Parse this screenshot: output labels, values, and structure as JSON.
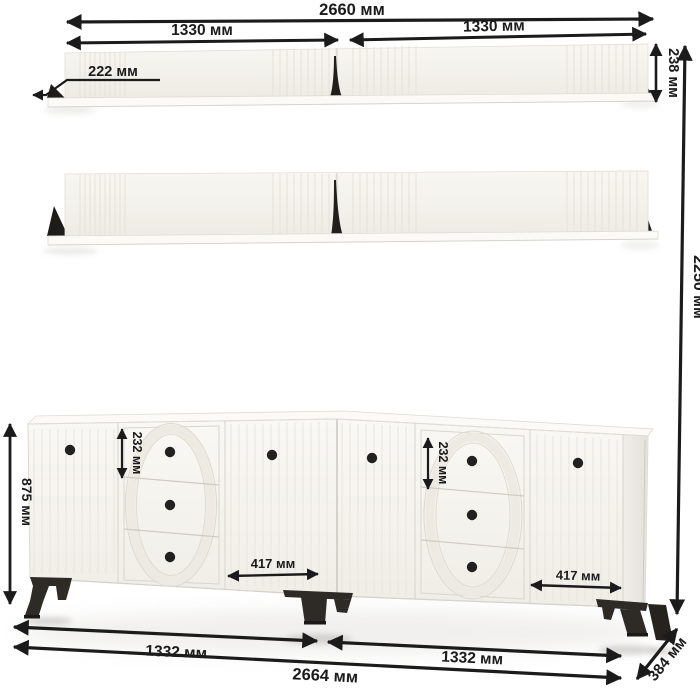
{
  "drawing": {
    "dims": {
      "top_total": "2660 мм",
      "top_half_left": "1330 мм",
      "top_half_right": "1330 мм",
      "shelf_depth": "222 мм",
      "shelf_height": "238 мм",
      "total_height": "2250 мм",
      "cabinet_height": "875 мм",
      "drawer_left": "232 мм",
      "drawer_right": "232 мм",
      "door_left": "417 мм",
      "door_right": "417 мм",
      "bottom_half_left": "1332 мм",
      "bottom_half_right": "1332 мм",
      "bottom_total": "2664 мм",
      "depth": "384 мм"
    },
    "colors": {
      "dimension_ink": "#1b1b1b",
      "furniture_light": "#f6f4ef",
      "furniture_dark": "#2e2b27"
    }
  }
}
